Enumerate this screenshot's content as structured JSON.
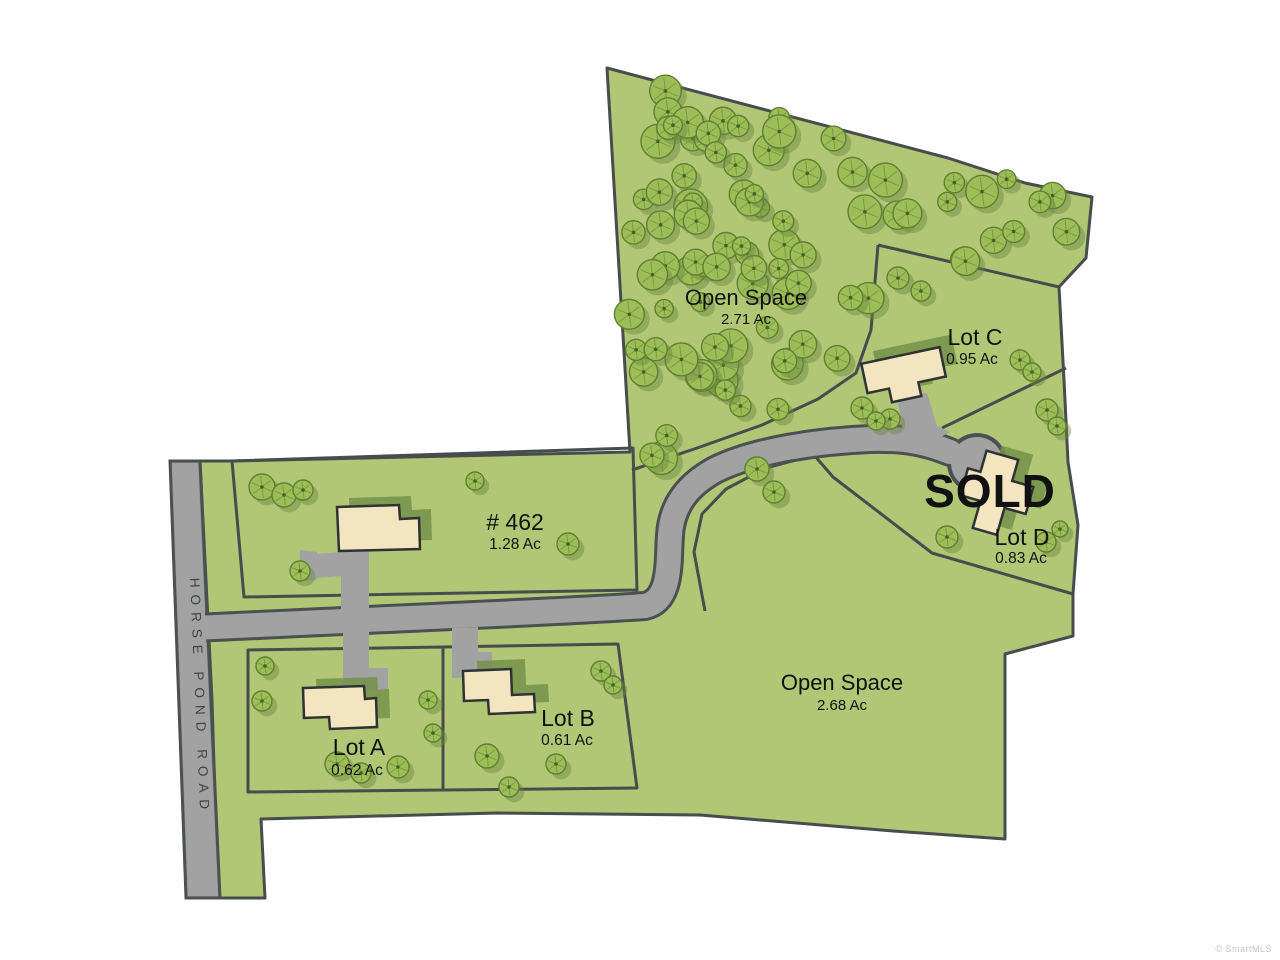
{
  "parcels": {
    "open_space_north": {
      "name": "Open Space",
      "area": "2.71 Ac"
    },
    "lot_c": {
      "name": "Lot C",
      "area": "0.95 Ac"
    },
    "lot_d": {
      "name": "Lot D",
      "area": "0.83 Ac",
      "status": "SOLD"
    },
    "lot_462": {
      "name": "# 462",
      "area": "1.28 Ac"
    },
    "lot_a": {
      "name": "Lot A",
      "area": "0.62 Ac"
    },
    "lot_b": {
      "name": "Lot B",
      "area": "0.61 Ac"
    },
    "open_space_south": {
      "name": "Open Space",
      "area": "2.68 Ac"
    }
  },
  "road": {
    "name": "HORSE POND ROAD"
  },
  "watermark": "© SmartMLS",
  "colors": {
    "parcel_green": "#b1c775",
    "boundary": "#474c4d",
    "road_gray": "#a2a2a2",
    "road_edge": "#4b5052",
    "tree_fill": "#9dbd58",
    "tree_stroke": "#5e8030",
    "tree_shadow": "#6d8743",
    "house_fill": "#f2e5c0",
    "house_stroke": "#2e3234",
    "house_shadow": "#76904a"
  }
}
